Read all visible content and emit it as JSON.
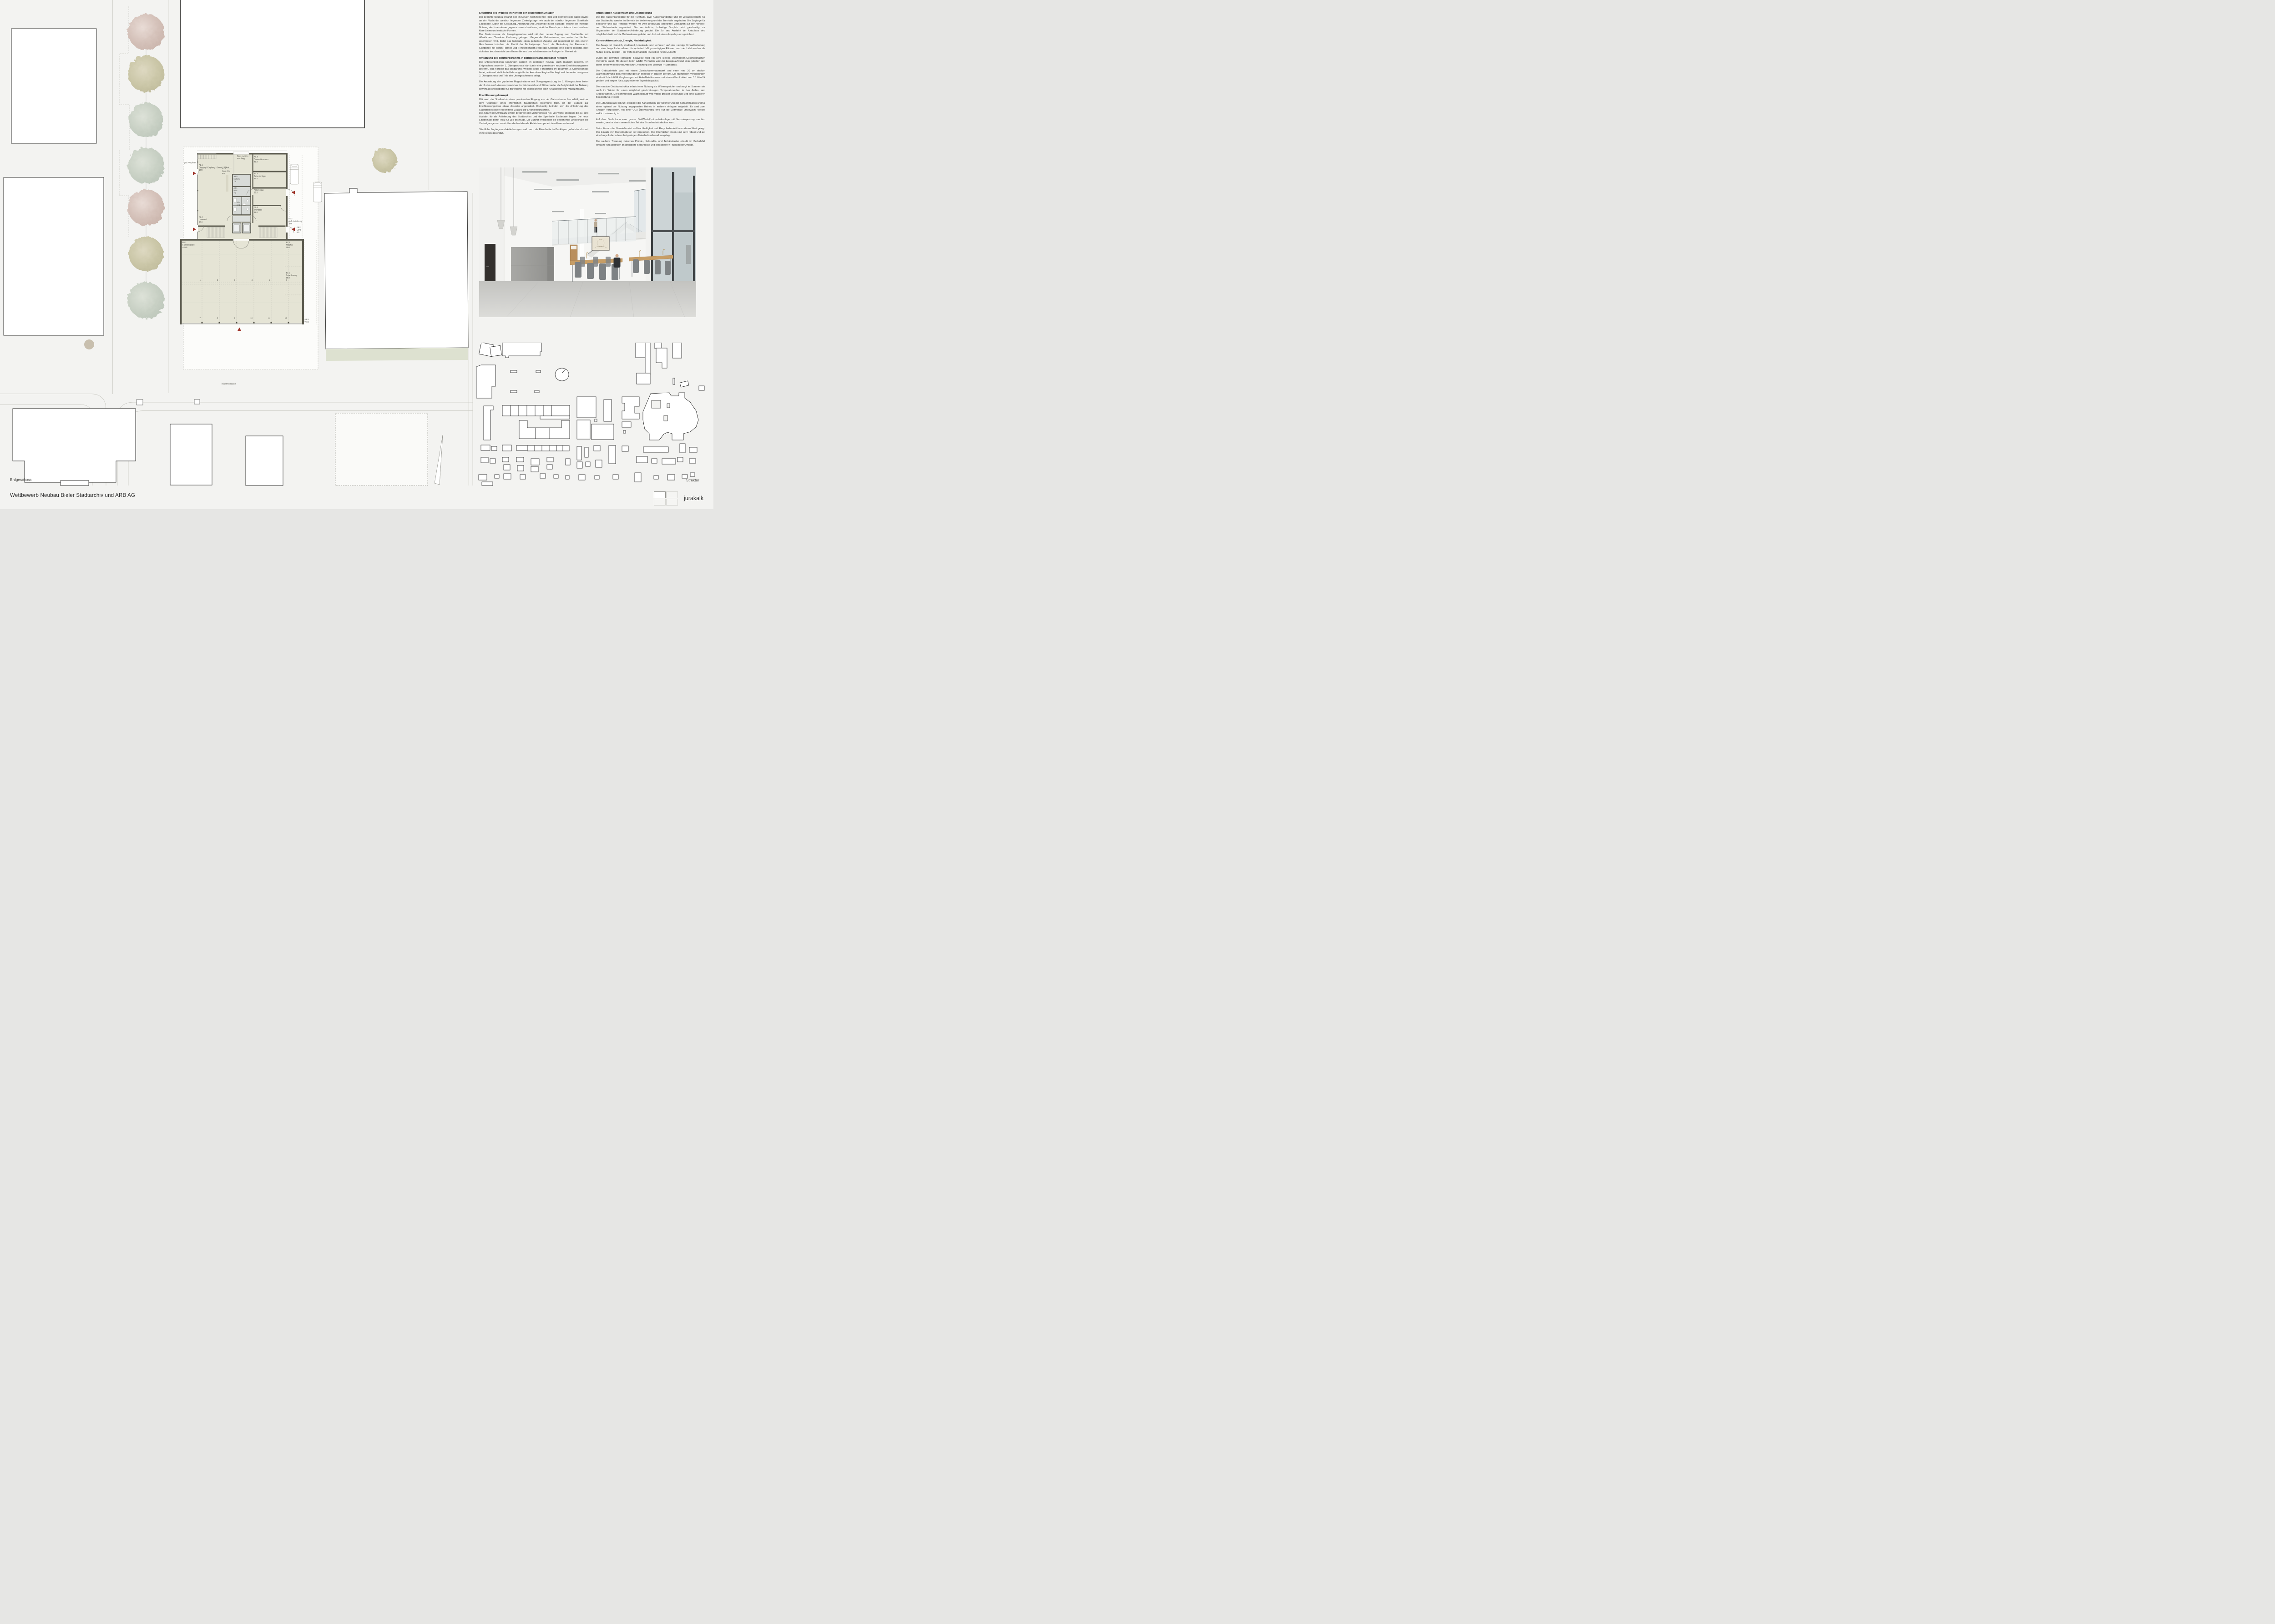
{
  "board": {
    "title": "Wettbewerb Neubau Bieler Stadtarchiv und ARB AG",
    "plan_caption": "Erdgeschoss",
    "struktur_caption": "Struktur",
    "logo": "jurakalk"
  },
  "site": {
    "street": "Mattenstrasse",
    "vorplatz": "ged. Vorplatz",
    "velos_code": "6.6.5",
    "velos": "Velos"
  },
  "floorplan": {
    "rooms": {
      "a21_code": "A2.1",
      "a21_name": "Eingang / Empfang / Dienst / Bibliot.....",
      "a21_area": "60.0",
      "buero_1": "Büro Aufsicht /",
      "buero_2": "Empfang",
      "a13_code": "A1.3",
      "a13_name": "Quarantäneraum",
      "a13_area": "22.0",
      "a15_code": "A1.5",
      "a15_name": "Material",
      "a15_area": "7.0",
      "a51_code": "A5.1",
      "a51_name": "Putz.",
      "a51_area": "7.0",
      "a23_code": "A2.3",
      "a23_name": "Gard. Pu.",
      "a23_area": "5.0",
      "a12_code": "A1.2",
      "a12_name": "Zwischenlager",
      "a12_area": "22.0",
      "a24_code": "A2.4",
      "a24_area": "14.0",
      "anl_name": "Anlieferung",
      "anl_area": "22.0",
      "a14_code": "A1.4",
      "a14_name": "Werkstatt",
      "a14_area": "22.0",
      "a22_code": "A2.2",
      "a22_name": "Lesesaal",
      "a22_area": "60.0",
      "a12b_code": "A1.2",
      "a12b_name": "ged. Anlieferung",
      "a12b_area": "20.0",
      "a52_code": "A5.2",
      "a52_name": "Cont.",
      "a52_area": "8.0",
      "b11_code": "B1.1",
      "b11_name": "Fahrzeughalle",
      "b11_area": "445.0",
      "b22_code": "B2.2",
      "b22_name": "Material",
      "b22_area": "30.0",
      "b21_code": "B2.1",
      "b21_name": "Retablierung",
      "b21_area": "50.0"
    },
    "stall_rows": [
      [
        "1",
        "2",
        "3",
        "4",
        "5",
        "6"
      ],
      [
        "7",
        "8",
        "9",
        "10",
        "11",
        "12"
      ]
    ]
  },
  "essay": {
    "col1": [
      {
        "heading": "Situierung des Projekts im Kontext der bestehenden Anlagen",
        "paragraphs": [
          "Der geplante Neubau ergänzt den im Geviert noch fehlende Platz und orientiert sich dabei sowohl an der Flucht der westlich liegenden Zentralgarage, wie auch der nördlich liegenden Sporthalle Esplanade. Durch die Gestaltung, Abstufung und Einschnitte in der Fassade, welche die jeweilige Nutzung der Innenräume gegen aussen abzeichnen, wirkt der Baukörper spielerisch und zeichnet klare Linien und einfache Formen.\nDer Gartenstrasse als Fussgängerachse wird mit dem neuen Zugang zum Stadtarchiv mit öffentlichem Charakter Rechnung getragen. Gegen die Mattenstrasse, von woher der Neubau erschlossen wird, bietet das Gebäude einen gedeckten Zugang und respektiert mit den oberen Geschossen trotzdem die Flucht der Zentralgarage. Durch die Gestaltung der Fassade in Sichtbeton mit klaren Formen und Fensterbändern erhält das Gebäude eine eigene Identität, hebt sich aber trotzdem nicht vom Ensemble und den schützenswerten Anlagen im Geviert ab."
        ]
      },
      {
        "heading": "Umsetzung des Raumprogramms in betriebsorganisatorischer Hinsicht",
        "paragraphs": [
          "Die unterschiedlichen Nutzungen werden im geplanten Neubau auch räumlich getrennt. Im Erdgeschoss sowie im 1. Obergeschoss klar durch eine gemeinsam nutzbare Erschliessungszone getrennt, liegt nördlich das Stadtarchiv, welches seine Fortsetzung im gesamten 3. Obergeschoss findet, während südlich die Fahrzeughalle der Ambulanz Region Biel liegt, welche weiter das ganze 2. Obergeschoss und Teile des Untergeschosses belegt.",
          "Die Anordnung der geplanten Magazinräume mit Übergangsnutzung im 3. Obergeschoss bietet durch den nach Aussen versetzten Korridorbereich und Stützenraster die Möglichkeit der Nutzung sowohl als Arbeitsplätze für Büroräume mit Tageslicht wie auch für abgedunkelte Magazinräume."
        ]
      },
      {
        "heading": "Erschliessungskonzept",
        "paragraphs": [
          "Während das Stadtarchiv einen prominenten Eingang von der Gartenstrasse her erhält, welcher dem Charakter eines öffentlichen Stadtarchivs Rechnung trägt, ist der Zugang zur Erschliessungszone etwas diskreter angeordnet. Rückseitig befinden sich die Anlieferung des Stadtarchivs sowie ein weiterer Zugang zur Erschliessungszone.\nDie Zufahrt der Ambulanz erfolgt direkt von der Mattenstrasse her, von woher ebenfalls die Zu- und Ausfahrt für die Anlieferung des Stadtarchivs und der Sporthalle Esplanade liegen. Die neue Einstellhalle bietet Platz für 28 Fahrzeuge. Die Zufahrt erfolgt über die bestehende Einstellhalle der Zentralgarage und somit über die bestehende Abfahrtsrampe auf dem Feuerwehrareal.",
          "Sämtliche Zugänge und Anlieferungen sind durch die Einschnitte im Baukörper gedeckt und somit vom Regen geschützt."
        ]
      }
    ],
    "col2": [
      {
        "heading": "Organisation Aussenraum und Erschliessung",
        "paragraphs": [
          "Die drei Aussenparkplätze für die Turnhalle, zwei Aussenparkplätze und 30 Veloabstellplätze für das Stadtarchiv werden im Bereich der Anlieferung und der Turnhalle angeboten. Die Zugänge für Besucher und das Personal werden mit zwei grosszügig gedeckten Vorplätzen auf der Nordost- und Südwestseite organisiert. Der nordöstliche, hofseitige Vorplatz wird gleichzeitig zur Organisation der Stadtarchiv-Anlieferung genutzt. Die Zu- und Ausfahrt der Ambulanz wird möglichst direkt auf die Mattenstrasse geleitet und dort mit einem Ampelsystem gesichert."
        ]
      },
      {
        "heading": "Konstruktionsprinzip,Energie, Nachhaltigkeit",
        "paragraphs": [
          "Die Anlage ist räumlich, strukturell, konstruktiv und technisch auf eine niedrige Umweltbelastung und eine lange Lebensdauer hin optimiert. Mit grosszügigen Räumen und viel Licht werden die Nutzer positiv geprägt – die wohl nachhaltigste Investition für die Zukunft.",
          "Durch die gewählte kompakte Bauweise wird ein sehr kleines Oberflächen-Geschossflächen Verhältnis erzielt. Mit diesem tiefen A/EBF Verhältnis wird der Energieaufwand klein gehalten und bietet einen wesentlichen Anteil zur Erreichung des Minergie P-Standards.",
          "Die Gebäudehülle wird mit einem Zweischalenmauerwerk und einer min. 20 cm starken Wärmedämmung den Anforderungen an Minergie P- Bauten gerecht. Die raumhohen Verglasungen sind mit 3-fach IV-R Verglasungen mit Holz-Metallrahmen und einem Glas U-Wert von 0.5 W/m2K geplant und sorgen für ausgezeichnete Tageslichtqualität.",
          "Die massive Gebäudestruktur erlaubt eine Nutzung als Wärmespeicher und sorgt im Sommer wie auch im Winter für einen möglichst gleichmässigen Temperaturverlauf in den Archiv- und Arbeitsräumen. Der sommerliche Wärmeschutz wird mittels grosser Vorsprünge und einer äusseren Beschattung erreicht.",
          "Die Lüftungsanlage ist zur Reduktion der Kanallängen, zur Optimierung der Schachtflächen und für einen optimal der Nutzung angepassten Betrieb in mehrere Anlagen aufgeteilt. Es sind zwei Anlagen vorgesehen. Mit einer CO2 Überwachung wird nur die Luftmenge umgewälzt, welche wirklich notwendig ist.",
          "Auf dem Dach kann eine grosse Ost-West-Photovoltaikanlage mit Netzeinspeisung montiert werden, welche einen wesentlichen Teil des Strombedarfs decken kann.",
          "Beim Einsatz der Baustoffe wird auf Nachhaltigkeit und Recyclierbarkeit besonderen Wert gelegt. Der Einsatz von Recyclingbeton ist vorgesehen. Die Oberflächen innen sind sehr robust und auf eine lange Lebensdauer bei geringem Unterhaltsaufwand ausgelegt.",
          "Die saubere Trennung zwischen Primär-, Sekundär- und Tertiärstruktur erlaubt im Bedarfsfall einfache Anpassungen an geänderte Bedürfnisse und den späteren Rückbau der Anlage."
        ]
      }
    ]
  },
  "colors": {
    "accent_red": "#9e3127",
    "plan_beige": "#e5e4d5",
    "wall_gray": "#5d5c50",
    "core_gray": "#d8dbd8",
    "green_strip": "#dde1d0",
    "tree_pink": "#d5c2ba",
    "tree_olive": "#cbc7a8",
    "tree_sage": "#c9d1c5"
  }
}
